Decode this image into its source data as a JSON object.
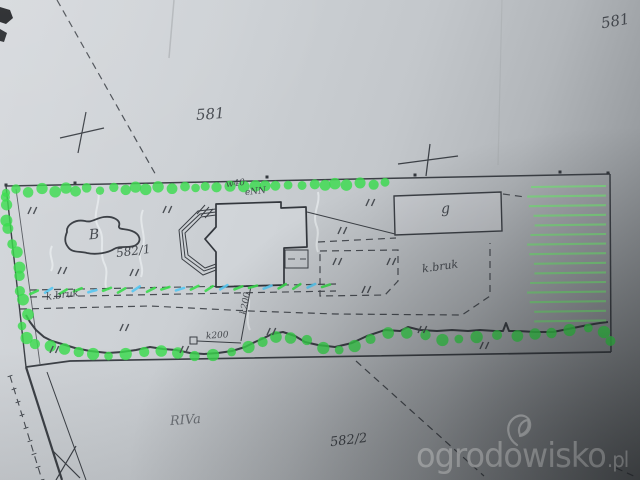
{
  "plan": {
    "parcels": {
      "parcel_top_right": "581",
      "parcel_center": "581",
      "parcel_main": "582/1",
      "parcel_bottom": "582/2"
    },
    "soil_class": "RIVa",
    "pond_label": "B",
    "garage_label": "g",
    "paving_label_left": "k.bruk",
    "paving_label_right": "k.bruk",
    "utilities": {
      "water": "w40",
      "electric": "eNN",
      "sewer_vertical": "k200",
      "sewer_horizontal": "k200"
    }
  },
  "watermark": {
    "name": "ogrodowisko",
    "tld": ".pl",
    "logo": "leaf-icon"
  },
  "colors": {
    "marker_green": "#3bdc4e",
    "hatch_green": "#7ce87e",
    "marker_blue": "#57c8f2",
    "ink": "#3c4046",
    "ink_dash": "#4a4e54",
    "paper_light": "#d5d8dc",
    "paper_dark": "#63676a",
    "watermark": "#f4f6f7"
  }
}
